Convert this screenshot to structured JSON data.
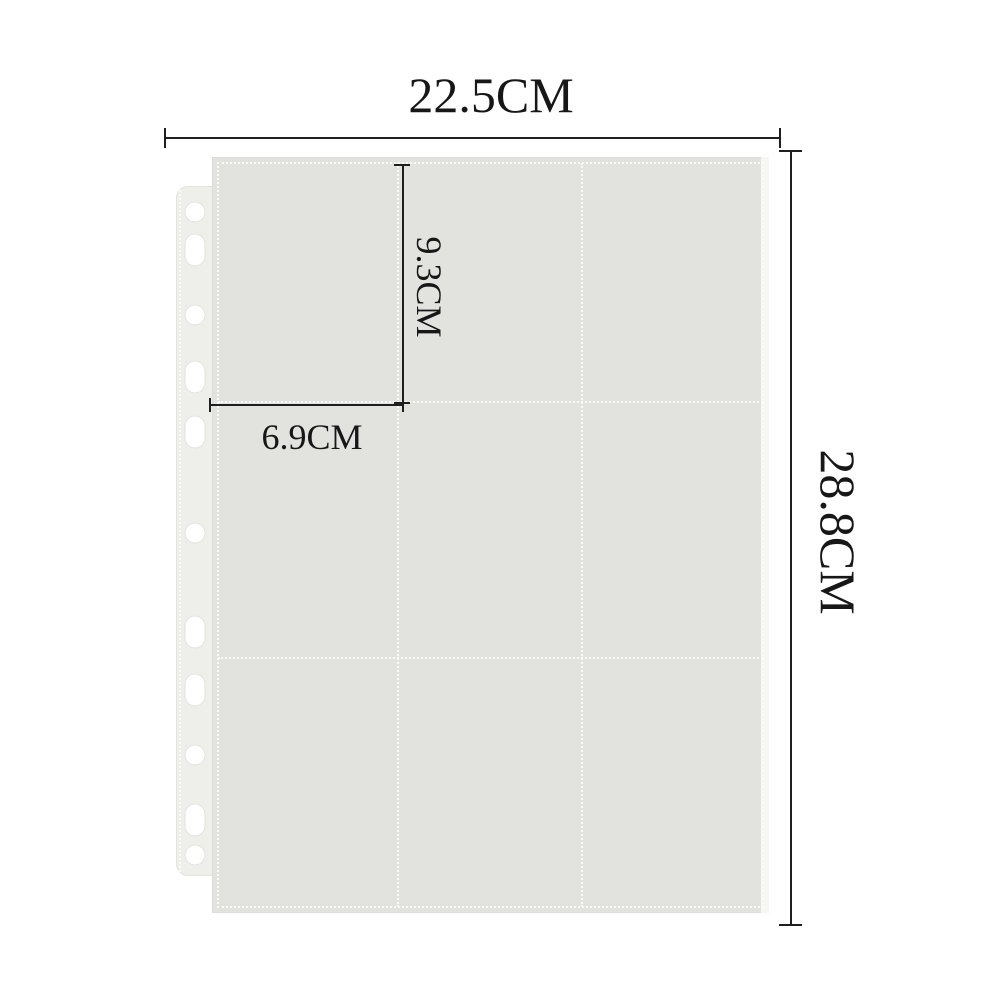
{
  "diagram": {
    "subject": "9-pocket binder page with dimension annotations",
    "dimensions": {
      "page_width": "22.5CM",
      "page_height": "28.8CM",
      "pocket_height": "9.3CM",
      "pocket_width": "6.9CM"
    },
    "pocket_grid": {
      "rows": 3,
      "cols": 3
    },
    "binder_strip": {
      "holes": [
        {
          "shape": "round",
          "y": 212
        },
        {
          "shape": "oblong",
          "y": 250
        },
        {
          "shape": "round",
          "y": 315
        },
        {
          "shape": "oblong",
          "y": 377
        },
        {
          "shape": "oblong",
          "y": 432
        },
        {
          "shape": "round",
          "y": 533
        },
        {
          "shape": "oblong",
          "y": 632
        },
        {
          "shape": "oblong",
          "y": 690
        },
        {
          "shape": "round",
          "y": 755
        },
        {
          "shape": "oblong",
          "y": 820
        },
        {
          "shape": "round",
          "y": 855
        }
      ]
    },
    "colors": {
      "background": "#ffffff",
      "sheet": "#e2e3df",
      "binder_strip": "#eeeeea",
      "seam_stitch": "#fafaf7",
      "dimension_line": "#1f1f1f",
      "label_text": "#171717"
    }
  }
}
